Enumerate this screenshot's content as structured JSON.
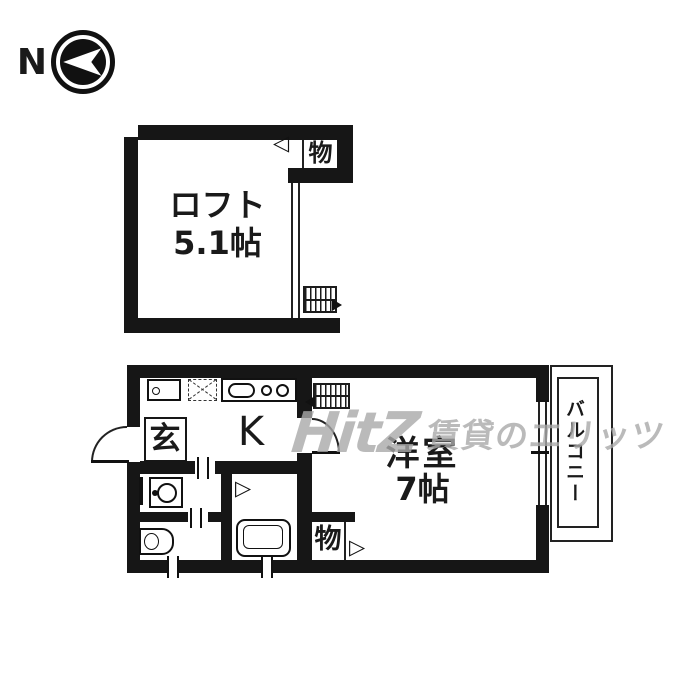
{
  "compass": {
    "north_label": "N"
  },
  "loft": {
    "name": "ロフト",
    "size": "5.1帖",
    "closet_label": "物"
  },
  "floor": {
    "kitchen_label": "K",
    "entrance_label": "玄",
    "room_label": "洋室",
    "room_size": "7帖",
    "storage_label": "物",
    "balcony_label": "バルコニー"
  },
  "icons": {
    "door_open_left": "◁",
    "door_open_right": "▷"
  },
  "watermark": {
    "logo": "HitZ",
    "text": "賃貸のエリッツ"
  }
}
